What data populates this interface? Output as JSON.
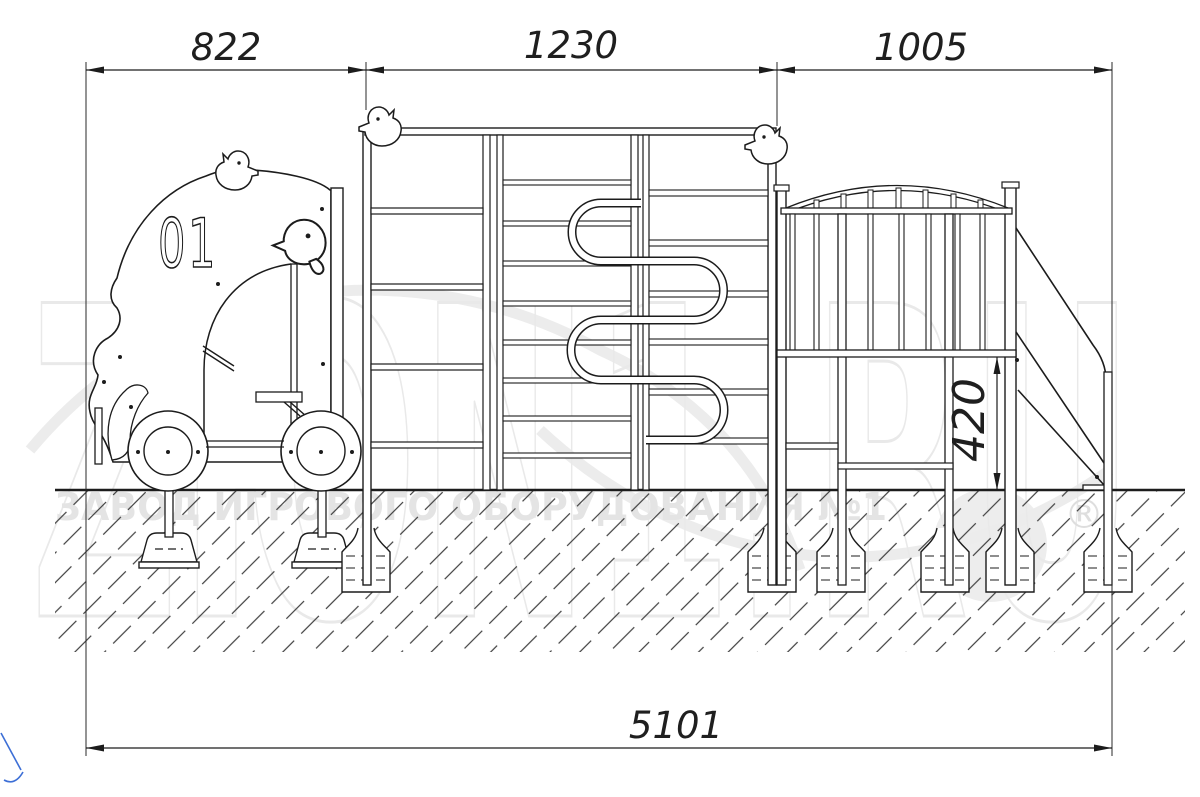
{
  "drawing": {
    "title": "playground-equipment-side-elevation",
    "dims": {
      "top": [
        "822",
        "1230",
        "1005"
      ],
      "total": "5101",
      "height": "420"
    }
  },
  "watermark": {
    "brand": "ZЮN1.RU",
    "tagline": "ЗАВОД ИГРОВОГО ОБОРУДОВАНИЯ №1",
    "reg": "®",
    "color": "#e9e9e9"
  },
  "car": {
    "number": "01"
  },
  "line_color": "#1c1c1c",
  "accent_blue": "#3d6fd6"
}
